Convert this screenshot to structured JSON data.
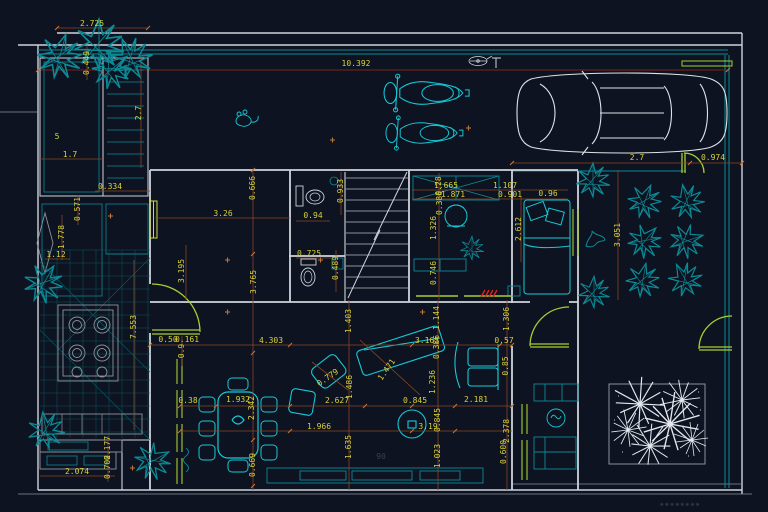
{
  "drawing_type": "cad-floor-plan",
  "watermark": "▪▪▪▪▪▪▪▪",
  "colors": {
    "background": "#0d1320",
    "wall": "#cfd3da",
    "wall_dim": "#8d939c",
    "teal_bright": "#17c8d6",
    "teal": "#0d8a96",
    "teal_dark": "#0b5e69",
    "dim_text": "#d8d23a",
    "dim_line": "#8a4526",
    "tick": "#c27434",
    "maroon": "#7a2418",
    "door_green": "#a8cf2f",
    "window_yellow": "#d8d835",
    "red": "#e02020",
    "white": "#ffffff",
    "car": "#dfe3e8",
    "foliage_white": "#e4e8ee",
    "watermark_color": "#454a55",
    "dark_text": "#3a3f4a"
  },
  "dimensions": [
    {
      "t": "2.725",
      "x": 92,
      "y": 24,
      "r": 0
    },
    {
      "t": "10.392",
      "x": 356,
      "y": 64,
      "r": 0
    },
    {
      "t": "2.7",
      "x": 637,
      "y": 158,
      "r": 0
    },
    {
      "t": "0.974",
      "x": 713,
      "y": 158,
      "r": 0
    },
    {
      "t": "0.449",
      "x": 87,
      "y": 63,
      "r": 90
    },
    {
      "t": "2.7",
      "x": 139,
      "y": 113,
      "r": 90
    },
    {
      "t": "5",
      "x": 57,
      "y": 137,
      "r": 0
    },
    {
      "t": "1.7",
      "x": 70,
      "y": 155,
      "r": 0
    },
    {
      "t": "0.334",
      "x": 110,
      "y": 187,
      "r": 0
    },
    {
      "t": "0.666",
      "x": 253,
      "y": 188,
      "r": 90
    },
    {
      "t": "3.26",
      "x": 223,
      "y": 214,
      "r": 0
    },
    {
      "t": "0.571",
      "x": 78,
      "y": 209,
      "r": 90
    },
    {
      "t": "1.778",
      "x": 62,
      "y": 237,
      "r": 90
    },
    {
      "t": "1.12",
      "x": 56,
      "y": 255,
      "r": 0
    },
    {
      "t": "3.195",
      "x": 182,
      "y": 271,
      "r": 90
    },
    {
      "t": "3.765",
      "x": 254,
      "y": 282,
      "r": 90
    },
    {
      "t": "0.933",
      "x": 341,
      "y": 191,
      "r": 90
    },
    {
      "t": "0.94",
      "x": 313,
      "y": 216,
      "r": 0
    },
    {
      "t": "0.725",
      "x": 309,
      "y": 254,
      "r": 0
    },
    {
      "t": "0.489",
      "x": 336,
      "y": 268,
      "r": 90
    },
    {
      "t": "1.665",
      "x": 446,
      "y": 186,
      "r": 0
    },
    {
      "t": "1.871",
      "x": 453,
      "y": 195,
      "r": 0
    },
    {
      "t": "1.107",
      "x": 505,
      "y": 186,
      "r": 0
    },
    {
      "t": "0.901",
      "x": 510,
      "y": 195,
      "r": 0
    },
    {
      "t": "0.96",
      "x": 548,
      "y": 194,
      "r": 0
    },
    {
      "t": "0.28",
      "x": 439,
      "y": 186,
      "r": 90
    },
    {
      "t": "0.386",
      "x": 440,
      "y": 203,
      "r": 90
    },
    {
      "t": "1.326",
      "x": 434,
      "y": 228,
      "r": 90
    },
    {
      "t": "2.612",
      "x": 519,
      "y": 229,
      "r": 90
    },
    {
      "t": "0.746",
      "x": 434,
      "y": 273,
      "r": 90
    },
    {
      "t": "3.051",
      "x": 618,
      "y": 235,
      "r": 90
    },
    {
      "t": "7.553",
      "x": 134,
      "y": 327,
      "r": 90
    },
    {
      "t": "0.50",
      "x": 168,
      "y": 340,
      "r": 0
    },
    {
      "t": "0.161",
      "x": 187,
      "y": 340,
      "r": 0
    },
    {
      "t": "0.9",
      "x": 182,
      "y": 351,
      "r": 90
    },
    {
      "t": "1.403",
      "x": 349,
      "y": 321,
      "r": 90
    },
    {
      "t": "1.144",
      "x": 437,
      "y": 318,
      "r": 90
    },
    {
      "t": "1.306",
      "x": 507,
      "y": 319,
      "r": 90
    },
    {
      "t": "4.303",
      "x": 271,
      "y": 341,
      "r": 0
    },
    {
      "t": "3.165",
      "x": 427,
      "y": 341,
      "r": 0
    },
    {
      "t": "0.57",
      "x": 504,
      "y": 341,
      "r": 0
    },
    {
      "t": "0.386",
      "x": 437,
      "y": 347,
      "r": 90
    },
    {
      "t": "1.471",
      "x": 387,
      "y": 370,
      "r": 55
    },
    {
      "t": "0.779",
      "x": 328,
      "y": 378,
      "r": 35
    },
    {
      "t": "1.486",
      "x": 350,
      "y": 387,
      "r": 90
    },
    {
      "t": "1.236",
      "x": 433,
      "y": 382,
      "r": 90
    },
    {
      "t": "0.85",
      "x": 506,
      "y": 366,
      "r": 90
    },
    {
      "t": "0.38",
      "x": 188,
      "y": 401,
      "r": 0
    },
    {
      "t": "1.932",
      "x": 238,
      "y": 400,
      "r": 0
    },
    {
      "t": "2.342",
      "x": 252,
      "y": 408,
      "r": 90
    },
    {
      "t": "2.627",
      "x": 337,
      "y": 401,
      "r": 0
    },
    {
      "t": "0.845",
      "x": 415,
      "y": 401,
      "r": 0
    },
    {
      "t": "2.181",
      "x": 476,
      "y": 400,
      "r": 0
    },
    {
      "t": "1.966",
      "x": 319,
      "y": 427,
      "r": 0
    },
    {
      "t": "3.19",
      "x": 428,
      "y": 427,
      "r": 0
    },
    {
      "t": "0.845",
      "x": 438,
      "y": 420,
      "r": 90
    },
    {
      "t": "1.635",
      "x": 349,
      "y": 447,
      "r": 90
    },
    {
      "t": "1.023",
      "x": 438,
      "y": 456,
      "r": 90
    },
    {
      "t": "2.378",
      "x": 507,
      "y": 431,
      "r": 90
    },
    {
      "t": "0.600",
      "x": 504,
      "y": 452,
      "r": 90
    },
    {
      "t": "0.669",
      "x": 253,
      "y": 465,
      "r": 90
    },
    {
      "t": "2.074",
      "x": 77,
      "y": 472,
      "r": 0
    },
    {
      "t": "0.702",
      "x": 108,
      "y": 467,
      "r": 90
    },
    {
      "t": "0.177",
      "x": 108,
      "y": 448,
      "r": 90
    },
    {
      "t": "90",
      "x": 381,
      "y": 457,
      "r": 0,
      "c": "#3a3f4a"
    }
  ]
}
